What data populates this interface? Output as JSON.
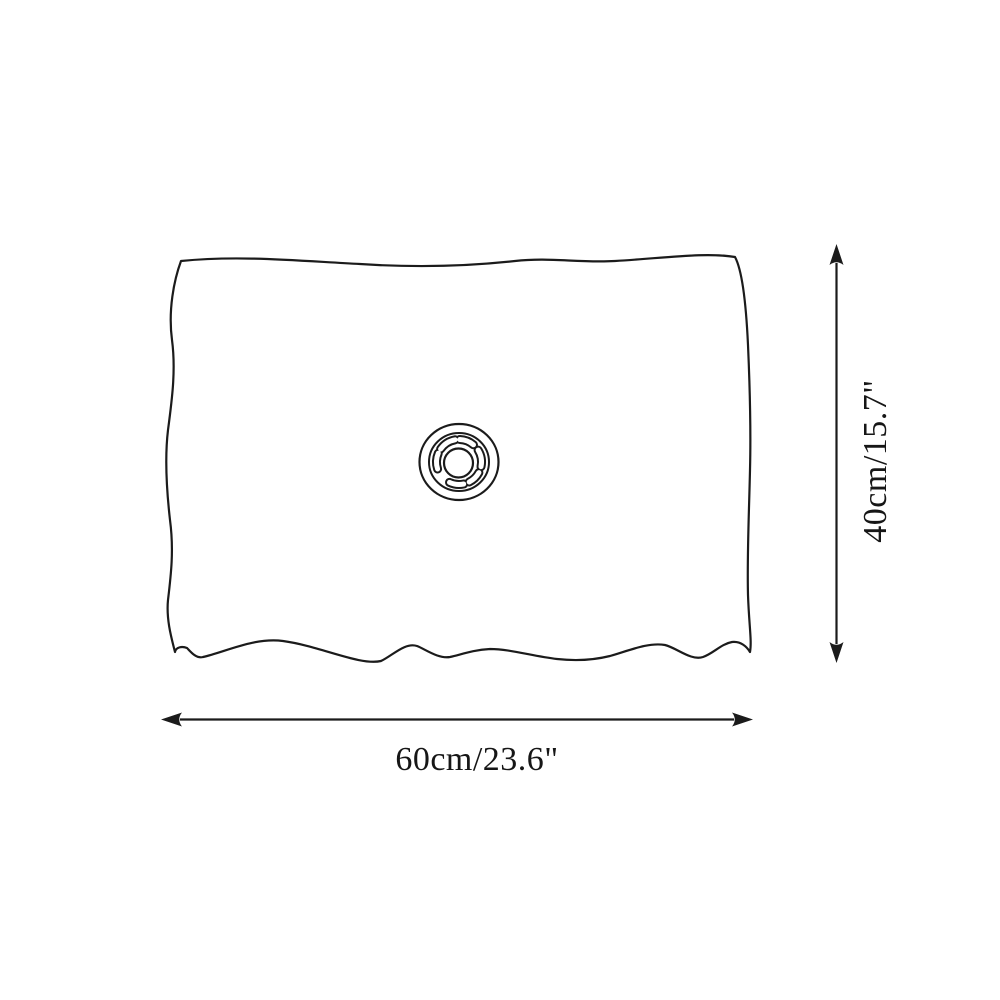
{
  "canvas": {
    "background_color": "#ffffff",
    "line_color": "#1b1b1b",
    "text_color": "#161616"
  },
  "diagram": {
    "type": "product-dimension-diagram",
    "dimensions": {
      "width": {
        "label": "60cm/23.6\"",
        "cm": 60,
        "inches": 23.6,
        "orientation": "horizontal"
      },
      "height": {
        "label": "40cm/15.7\"",
        "cm": 40,
        "inches": 15.7,
        "orientation": "vertical"
      }
    }
  }
}
